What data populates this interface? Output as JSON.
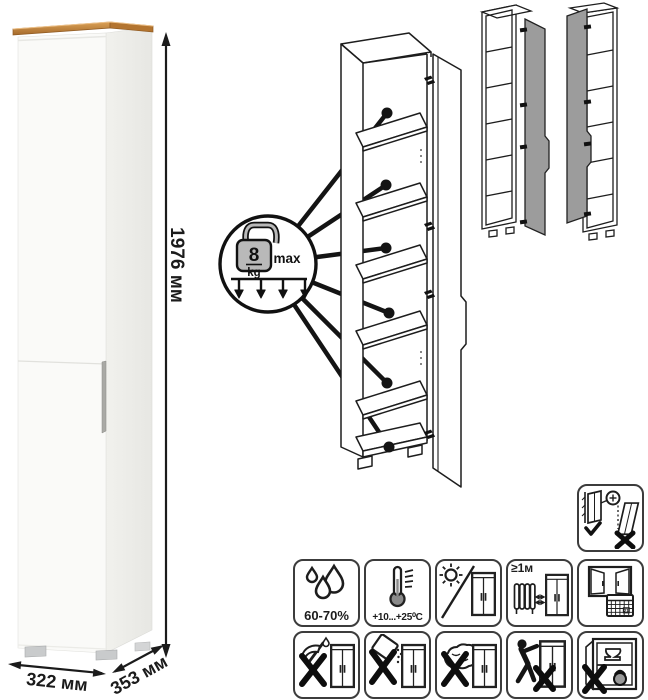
{
  "dimensions": {
    "height": "1976 мм",
    "width": "322 мм",
    "depth": "353 мм"
  },
  "load_badge": {
    "value": "8",
    "unit": "kg",
    "label": "max"
  },
  "icon_tiles": {
    "row1": [
      {
        "name": "humidity-icon",
        "label": "60-70%"
      },
      {
        "name": "temperature-range-icon",
        "label": "+10...+25⁰C"
      },
      {
        "name": "no-direct-sunlight-icon"
      },
      {
        "name": "heat-source-distance-icon",
        "label": "≥1м"
      },
      {
        "name": "ventilation-calendar-icon",
        "label": "21"
      }
    ],
    "row2": [
      {
        "name": "no-sharp-tools-icon"
      },
      {
        "name": "no-abrasive-cleaners-icon"
      },
      {
        "name": "no-wet-cloth-icon"
      },
      {
        "name": "no-pushing-when-moving-icon"
      },
      {
        "name": "no-overloading-icon"
      }
    ],
    "anchor": {
      "name": "anchor-to-wall-icon"
    }
  },
  "colors": {
    "wood_top": "#c08440",
    "door_gray": "#9c9c9c",
    "line": "#1d1d1d"
  }
}
